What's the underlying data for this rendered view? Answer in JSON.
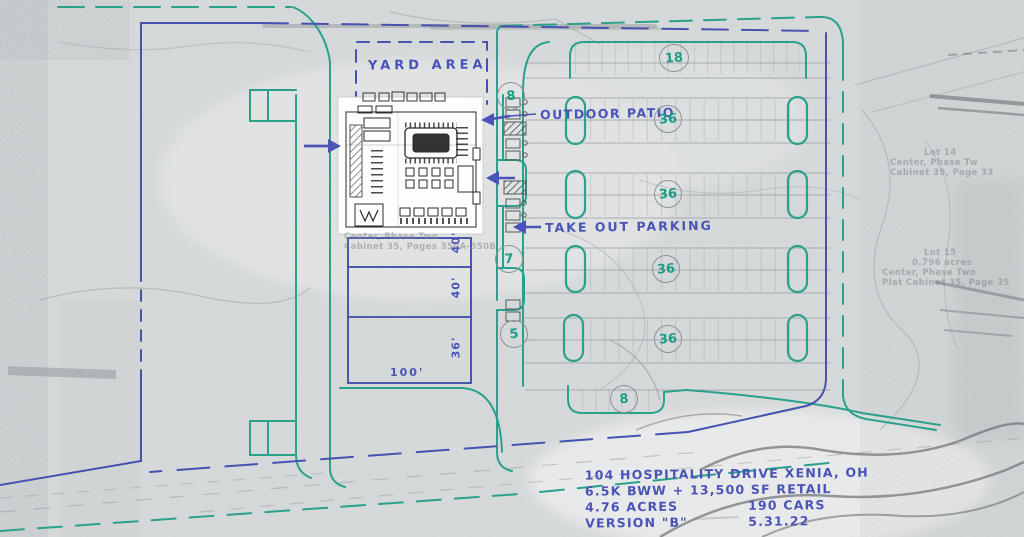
{
  "colors": {
    "ink_blue": "#4a53b6",
    "property_blue": "#4553ae",
    "curb_teal": "#2aa18c",
    "count_teal": "#1d9c86",
    "pencil_grey": "#8d9297",
    "paper_grey": "#d9dcdd"
  },
  "labels": {
    "yard_area": "YARD AREA",
    "outdoor_patio": "OUTDOOR PATIO",
    "take_out_parking": "TAKE OUT PARKING"
  },
  "counts": [
    {
      "value": "8"
    },
    {
      "value": "18"
    },
    {
      "value": "36"
    },
    {
      "value": "36"
    },
    {
      "value": "7"
    },
    {
      "value": "36"
    },
    {
      "value": "5"
    },
    {
      "value": "36"
    },
    {
      "value": "8"
    }
  ],
  "bays": {
    "bay1": "40'",
    "bay2": "40'",
    "bay3": "36'",
    "depth": "100'"
  },
  "title_block": {
    "line1_left": "104 HOSPITALITY DRIVE",
    "line1_right": "XENIA, OH",
    "line2": "6.5K BWW + 13,500 SF RETAIL",
    "line3_left": "4.76 ACRES",
    "line3_right": "190 CARS",
    "line4_left": "VERSION \"B\"",
    "line4_right": "5.31.22"
  },
  "faint_texts": {
    "under_building_1": "Center, Phase Two",
    "under_building_2": "Cabinet 35, Pages 350A-350B",
    "right_mid_1": "Lot 14",
    "right_mid_2": "Center, Phase Tw",
    "right_mid_3": "Cabinet 35, Page 33",
    "right_low_1": "Lot 15",
    "right_low_2": "0.796 acres",
    "right_low_3": "Center, Phase Two",
    "right_low_4": "Plat Cabinet 35, Page 35"
  }
}
